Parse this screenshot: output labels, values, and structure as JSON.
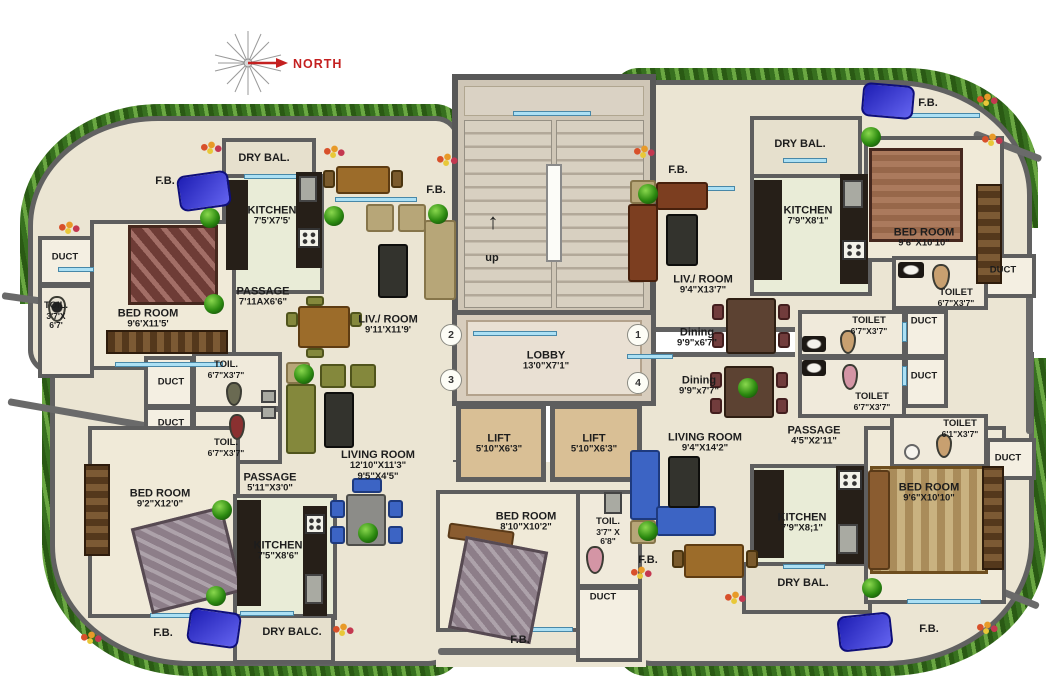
{
  "colors": {
    "wall": "#5e5e5e",
    "floor": "#ebe5d3",
    "kitchen_floor": "#e9ecd7",
    "hedge_green": "#4e8a2e",
    "window_blue": "#ace0f4",
    "north_red": "#c42020",
    "lift_floor": "#d9bf95"
  },
  "compass": {
    "label": "NORTH"
  },
  "stairs": {
    "label": "up",
    "arrow": "↑"
  },
  "lobby": {
    "name": "LOBBY",
    "dims": "13'0\"X7'1\""
  },
  "lifts": [
    {
      "name": "LIFT",
      "dims": "5'10\"X6'3\""
    },
    {
      "name": "LIFT",
      "dims": "5'10\"X6'3\""
    }
  ],
  "markers": {
    "m1": "1",
    "m2": "2",
    "m3": "3",
    "m4": "4"
  },
  "rooms": {
    "u2_fb_left": {
      "name": "F.B."
    },
    "u2_drybal": {
      "name": "DRY BAL."
    },
    "u2_kitchen": {
      "name": "KITCHEN",
      "dims": "7'5'X7'5'"
    },
    "u2_duct": {
      "name": "DUCT"
    },
    "u2_toil": {
      "name": "TOIL.",
      "dims": "3'7'X",
      "dims2": "6'7'"
    },
    "u2_bedroom": {
      "name": "BED ROOM",
      "dims": "9'6'X11'5'"
    },
    "u2_passage": {
      "name": "PASSAGE",
      "dims": "7'11AX6'6\""
    },
    "u2_livroom": {
      "name": "LIV./ ROOM",
      "dims": "9'11'X11'9'"
    },
    "u2_fb_right": {
      "name": "F.B."
    },
    "u1_fb_left": {
      "name": "F.B."
    },
    "u1_drybal": {
      "name": "DRY BAL."
    },
    "u1_kitchen": {
      "name": "KITCHEN",
      "dims": "7'9\"X8'1\""
    },
    "u1_fb_right": {
      "name": "F.B."
    },
    "u1_bedroom": {
      "name": "BED ROOM",
      "dims": "9'6\"X10'10\""
    },
    "u1_livroom": {
      "name": "LIV./ ROOM",
      "dims": "9'4\"X13'7\""
    },
    "u1_dining": {
      "name": "Dining",
      "dims": "9'9\"x6'7\""
    },
    "u1_toilet": {
      "name": "TOILET",
      "dims": "6'7\"X3'7\""
    },
    "u1_duct": {
      "name": "DUCT"
    },
    "mr_toilet1": {
      "name": "TOILET",
      "dims": "6'7\"X3'7\""
    },
    "mr_duct1": {
      "name": "DUCT"
    },
    "mr_duct2": {
      "name": "DUCT"
    },
    "mr_toilet2": {
      "name": "TOILET",
      "dims": "6'7\"X3'7\""
    },
    "u4_dining": {
      "name": "Dining",
      "dims": "9'9\"x7'7\""
    },
    "u4_livroom": {
      "name": "LIVING ROOM",
      "dims": "9'4\"X14'2\""
    },
    "u4_passage": {
      "name": "PASSAGE",
      "dims": "4'5\"X2'11\""
    },
    "u4_toilet": {
      "name": "TOILET",
      "dims": "6'1\"X3'7\""
    },
    "u4_duct": {
      "name": "DUCT"
    },
    "u4_bedroom": {
      "name": "BED ROOM",
      "dims": "9'6\"X10'10\""
    },
    "u4_kitchen": {
      "name": "KITCHEN",
      "dims": "7'9\"X8;1\""
    },
    "u4_fb_left": {
      "name": "F.B."
    },
    "u4_drybal": {
      "name": "DRY BAL."
    },
    "u4_fb_bottom": {
      "name": "F.B."
    },
    "u3_toil1": {
      "name": "TOIL.",
      "dims": "6'7\"X3'7\""
    },
    "u3_duct1": {
      "name": "DUCT"
    },
    "u3_duct2": {
      "name": "DUCT"
    },
    "u3_toil2": {
      "name": "TOIL.",
      "dims": "6'7\"X3'7\""
    },
    "u3_passage": {
      "name": "PASSAGE",
      "dims": "5'11\"X3'0\""
    },
    "u3_bedroom": {
      "name": "BED ROOM",
      "dims": "9'2\"X12'0\""
    },
    "u3_kitchen": {
      "name": "KITCHEN",
      "dims": "7'5\"X8'6\""
    },
    "u3_livroom": {
      "name": "LIVING ROOM",
      "dims": "12'10\"X11'3\"",
      "dims2": "9'5\"X4'5\""
    },
    "u3_fb": {
      "name": "F.B."
    },
    "u3_drybalc": {
      "name": "DRY BALC."
    },
    "c_bedroom": {
      "name": "BED ROOM",
      "dims": "8'10\"X10'2\""
    },
    "c_toil": {
      "name": "TOIL.",
      "dims": "3'7\" X",
      "dims2": "6'8\""
    },
    "c_duct": {
      "name": "DUCT"
    },
    "c_fb": {
      "name": "F.B."
    }
  }
}
